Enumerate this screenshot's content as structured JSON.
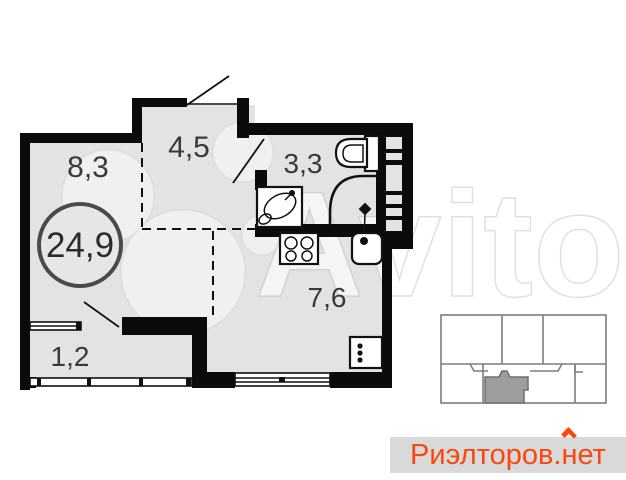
{
  "floorplan": {
    "rooms": {
      "living": {
        "area": "8,3"
      },
      "hallway": {
        "area": "4,5"
      },
      "bathroom": {
        "area": "3,3"
      },
      "kitchen": {
        "area": "7,6"
      },
      "balcony": {
        "area": "1,2"
      },
      "total": {
        "area": "24,9"
      }
    }
  },
  "watermarks": {
    "avito": {
      "text": "Avito"
    },
    "realtor": {
      "prefix": "Риэлторов.",
      "house_letter": "н",
      "rest": "ет",
      "color": "#f8480e",
      "background": "#d9d9d9"
    }
  },
  "colors": {
    "wall": "#0b0b0b",
    "room_fill": "#e3e3e3",
    "label": "#3a3a3a",
    "minimap_line": "#7d7d7d",
    "minimap_highlight": "#9d9d9d"
  }
}
